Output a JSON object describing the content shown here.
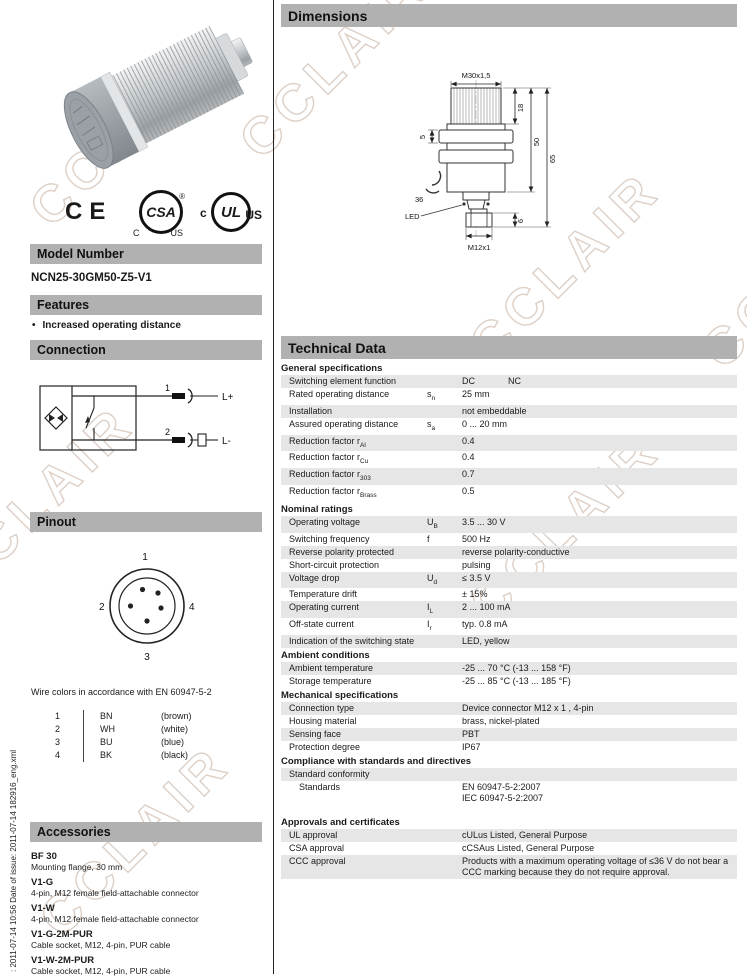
{
  "watermark": {
    "text": "CCLAIR"
  },
  "sidebar_text": ": 2011-07-14 10:56    Date of issue: 2011-07-14    182916_eng.xml",
  "left": {
    "model_header": "Model Number",
    "model_number": "NCN25-30GM50-Z5-V1",
    "features_header": "Features",
    "bullet": "•",
    "feature_1": "Increased operating distance",
    "connection_header": "Connection",
    "conn": {
      "pin1": "1",
      "pin2": "2",
      "lplus": "L+",
      "lminus": "L-"
    },
    "pinout_header": "Pinout",
    "pins": {
      "p1": "1",
      "p2": "2",
      "p3": "3",
      "p4": "4"
    },
    "wire_note": "Wire colors in accordance with EN 60947-5-2",
    "wires": [
      {
        "pin": "1",
        "code": "BN",
        "color": "(brown)"
      },
      {
        "pin": "2",
        "code": "WH",
        "color": "(white)"
      },
      {
        "pin": "3",
        "code": "BU",
        "color": "(blue)"
      },
      {
        "pin": "4",
        "code": "BK",
        "color": "(black)"
      }
    ],
    "accessories_header": "Accessories",
    "accessories": [
      {
        "name": "BF 30",
        "desc": "Mounting flange, 30 mm"
      },
      {
        "name": "V1-G",
        "desc": "4-pin, M12 female field-attachable connector"
      },
      {
        "name": "V1-W",
        "desc": "4-pin, M12 female field-attachable connector"
      },
      {
        "name": "V1-G-2M-PUR",
        "desc": "Cable socket, M12, 4-pin, PUR cable"
      },
      {
        "name": "V1-W-2M-PUR",
        "desc": "Cable socket, M12, 4-pin, PUR cable"
      }
    ],
    "logos": {
      "ce": "CE",
      "csa": "CSA",
      "csa_c": "C",
      "csa_us": "US",
      "reg": "®",
      "ul": "UL",
      "ul_c": "c",
      "ul_us": "US"
    }
  },
  "right": {
    "dimensions_header": "Dimensions",
    "dims": {
      "thread": "M30x1,5",
      "d18": "18",
      "d50": "50",
      "d65": "65",
      "d5": "5",
      "d36": "36",
      "led": "LED",
      "connector": "M12x1",
      "d6": "6"
    },
    "technical_header": "Technical Data",
    "sections": [
      {
        "title": "General specifications",
        "rows": [
          {
            "label": "Switching element function",
            "value": "DC",
            "value2": "NC"
          },
          {
            "label": "Rated operating distance",
            "sym": "s",
            "symsub": "n",
            "value": "25 mm"
          },
          {
            "label": "Installation",
            "value": "not embeddable"
          },
          {
            "label": "Assured operating distance",
            "sym": "s",
            "symsub": "a",
            "value": "0 ... 20 mm"
          },
          {
            "label": "Reduction factor r",
            "labelsub": "Al",
            "value": "0.4"
          },
          {
            "label": "Reduction factor r",
            "labelsub": "Cu",
            "value": "0.4"
          },
          {
            "label": "Reduction factor r",
            "labelsub": "303",
            "value": "0.7"
          },
          {
            "label": "Reduction factor r",
            "labelsub": "Brass",
            "value": "0.5"
          }
        ]
      },
      {
        "title": "Nominal ratings",
        "rows": [
          {
            "label": "Operating voltage",
            "sym": "U",
            "symsub": "B",
            "value": "3.5 ... 30 V"
          },
          {
            "label": "Switching frequency",
            "sym": "f",
            "value": "500 Hz"
          },
          {
            "label": "Reverse polarity protected",
            "value": "reverse polarity-conductive"
          },
          {
            "label": "Short-circuit protection",
            "value": "pulsing"
          },
          {
            "label": "Voltage drop",
            "sym": "U",
            "symsub": "d",
            "value": "≤ 3.5 V"
          },
          {
            "label": "Temperature drift",
            "value": "± 15%"
          },
          {
            "label": "Operating current",
            "sym": "I",
            "symsub": "L",
            "value": "2 ... 100 mA"
          },
          {
            "label": "Off-state current",
            "sym": "I",
            "symsub": "r",
            "value": "typ. 0.8 mA"
          },
          {
            "label": "Indication of the switching state",
            "value": "LED, yellow"
          }
        ]
      },
      {
        "title": "Ambient conditions",
        "rows": [
          {
            "label": "Ambient temperature",
            "value": "-25 ... 70 °C (-13 ... 158 °F)"
          },
          {
            "label": "Storage temperature",
            "value": "-25 ... 85 °C (-13 ... 185 °F)"
          }
        ]
      },
      {
        "title": "Mechanical specifications",
        "rows": [
          {
            "label": "Connection type",
            "value": "Device connector M12 x 1 , 4-pin"
          },
          {
            "label": "Housing material",
            "value": "brass, nickel-plated"
          },
          {
            "label": "Sensing face",
            "value": "PBT"
          },
          {
            "label": "Protection degree",
            "value": "IP67"
          }
        ]
      },
      {
        "title": "Compliance with standards and directives",
        "rows": [
          {
            "label": "Standard conformity"
          },
          {
            "label": "Standards",
            "indent": 2,
            "value_lines": [
              "EN 60947-5-2:2007",
              "IEC 60947-5-2:2007"
            ]
          }
        ]
      },
      {
        "title": "Approvals and certificates",
        "gap_before": true,
        "rows": [
          {
            "label": "UL approval",
            "value": "cULus Listed, General Purpose"
          },
          {
            "label": "CSA approval",
            "value": "cCSAus Listed, General Purpose"
          },
          {
            "label": "CCC approval",
            "value_lines": [
              "Products with a maximum operating voltage of ≤36 V do not bear a",
              "CCC marking because they do not require approval."
            ]
          }
        ]
      }
    ]
  }
}
